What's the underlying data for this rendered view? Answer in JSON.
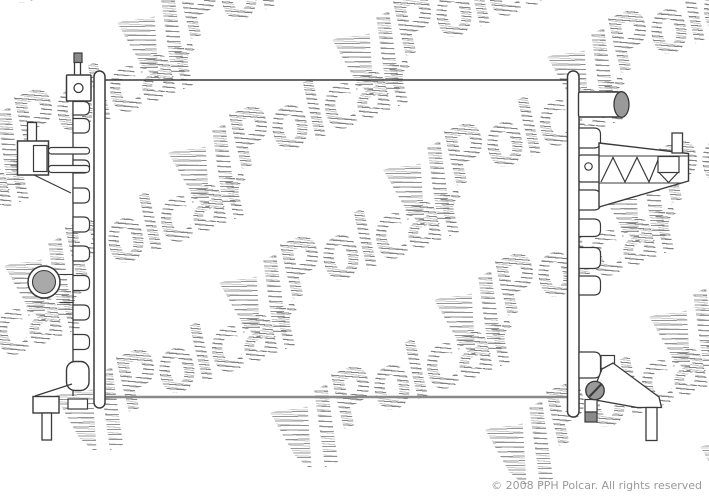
{
  "image": {
    "width": 709,
    "height": 496,
    "background": "#ffffff",
    "description": "Technical line drawing of an automotive radiator from a Polcar parts catalog"
  },
  "copyright": {
    "text": "© 2008 PPH Polcar. All rights reserved",
    "color": "#9a9a9a"
  },
  "watermark": {
    "text": "Polcar",
    "rotation_deg": -22,
    "stripe_color": "#828282",
    "lattice": {
      "origin": [
        325,
        22
      ],
      "col_step": [
        215,
        17
      ],
      "row_step": [
        51,
        130
      ],
      "cols": [
        -3,
        2
      ],
      "rows": [
        0,
        3
      ]
    }
  },
  "palette": {
    "line": "#3a3a3a",
    "light_line": "#8a8a8a",
    "white": "#ffffff",
    "gray_fill": "#a9a9a9",
    "mid_gray": "#999999",
    "dark_gray": "#8a8a8a",
    "none": "none"
  },
  "drawing": {
    "shapes": [
      {
        "name": "core-top-edge",
        "type": "line",
        "x1": 104,
        "y1": 80,
        "x2": 569,
        "y2": 80,
        "stroke": "line",
        "sw": 1.6
      },
      {
        "name": "core-bottom-edge",
        "type": "line",
        "x1": 104,
        "y1": 397,
        "x2": 569,
        "y2": 397,
        "stroke": "light_line",
        "sw": 2.6
      },
      {
        "name": "left-side-plate",
        "type": "rect",
        "x": 94,
        "y": 71,
        "w": 11,
        "h": 337,
        "rx": 5.5,
        "fill": "white",
        "stroke": "line",
        "sw": 1.5
      },
      {
        "name": "right-side-plate",
        "type": "rect",
        "x": 567.5,
        "y": 71,
        "w": 11.5,
        "h": 346,
        "rx": 5.5,
        "fill": "white",
        "stroke": "line",
        "sw": 1.5
      },
      {
        "name": "left-tank-edge",
        "type": "line",
        "x1": 73,
        "y1": 100.5,
        "x2": 73,
        "y2": 396,
        "stroke": "line",
        "sw": 1.3
      },
      {
        "name": "left-tank-tabs",
        "type": "tabs",
        "x": 73,
        "w": 16.5,
        "r": 6,
        "stroke": "line",
        "sw": 1.2,
        "fill": "white",
        "items": [
          [
            101.5,
            13.5
          ],
          [
            118.5,
            14.5
          ],
          [
            160,
            13
          ],
          [
            188,
            15
          ],
          [
            217,
            15
          ],
          [
            246,
            15
          ],
          [
            275.5,
            15
          ],
          [
            305,
            15
          ],
          [
            334.5,
            15
          ]
        ]
      },
      {
        "name": "bleed-screw-stem",
        "type": "rect",
        "x": 74.5,
        "y": 61.5,
        "w": 6,
        "h": 14,
        "rx": 0,
        "fill": "white",
        "stroke": "line",
        "sw": 1.3
      },
      {
        "name": "bleed-screw-cap",
        "type": "rect",
        "x": 74,
        "y": 53,
        "w": 8,
        "h": 9.5,
        "rx": 0,
        "fill": "dark_gray",
        "stroke": "line",
        "sw": 1.2
      },
      {
        "name": "upper-mount-bracket",
        "type": "rect",
        "x": 66.5,
        "y": 75,
        "w": 24.5,
        "h": 26,
        "rx": 1,
        "fill": "white",
        "stroke": "line",
        "sw": 1.5
      },
      {
        "name": "upper-bracket-hole",
        "type": "circle",
        "cx": 78.5,
        "cy": 88,
        "r": 4.5,
        "fill": "white",
        "stroke": "line",
        "sw": 1.3
      },
      {
        "name": "hose-clamp-stem",
        "type": "rect",
        "x": 27.5,
        "y": 122.5,
        "w": 9,
        "h": 19.5,
        "rx": 0,
        "fill": "white",
        "stroke": "line",
        "sw": 1.3
      },
      {
        "name": "hose-clamp-body",
        "type": "rect",
        "x": 17.5,
        "y": 141,
        "w": 31,
        "h": 34,
        "rx": 0,
        "fill": "white",
        "stroke": "line",
        "sw": 1.5
      },
      {
        "name": "hose-clamp-inner",
        "type": "rect",
        "x": 33.5,
        "y": 145.5,
        "w": 13.5,
        "h": 26,
        "rx": 0,
        "fill": "white",
        "stroke": "line",
        "sw": 1.2
      },
      {
        "name": "clamp-bar-upper",
        "type": "rect",
        "x": 48.5,
        "y": 147.5,
        "w": 41,
        "h": 6.5,
        "rx": 3,
        "fill": "white",
        "stroke": "line",
        "sw": 1.2
      },
      {
        "name": "clamp-bar-lower",
        "type": "rect",
        "x": 48.5,
        "y": 165.5,
        "w": 41,
        "h": 7,
        "rx": 3,
        "fill": "white",
        "stroke": "line",
        "sw": 1.2
      },
      {
        "name": "clamp-diagonal",
        "type": "line",
        "x1": 34,
        "y1": 175,
        "x2": 71,
        "y2": 193,
        "stroke": "line",
        "sw": 1.2
      },
      {
        "name": "left-port-ring",
        "type": "circle",
        "cx": 44,
        "cy": 282,
        "r": 16,
        "fill": "white",
        "stroke": "line",
        "sw": 1.5
      },
      {
        "name": "left-port-plug",
        "type": "circle",
        "cx": 44,
        "cy": 282,
        "r": 11.5,
        "fill": "gray_fill",
        "stroke": "line",
        "sw": 1.1
      },
      {
        "name": "left-port-line-upper",
        "type": "line",
        "x1": 59.5,
        "y1": 274.5,
        "x2": 73,
        "y2": 274.5,
        "stroke": "line",
        "sw": 1.1
      },
      {
        "name": "left-port-line-lower",
        "type": "line",
        "x1": 59.5,
        "y1": 302.5,
        "x2": 73,
        "y2": 302.5,
        "stroke": "line",
        "sw": 1.1
      },
      {
        "name": "lower-left-tab",
        "type": "rect",
        "x": 66.5,
        "y": 361.5,
        "w": 22.5,
        "h": 29,
        "rx": 8.5,
        "fill": "white",
        "stroke": "line",
        "sw": 1.4
      },
      {
        "name": "left-foot",
        "type": "rect",
        "x": 33,
        "y": 396.5,
        "w": 26,
        "h": 16.5,
        "rx": 0,
        "fill": "white",
        "stroke": "line",
        "sw": 1.4
      },
      {
        "name": "left-foot-diagonal",
        "type": "line",
        "x1": 35,
        "y1": 396,
        "x2": 72,
        "y2": 384,
        "stroke": "line",
        "sw": 1.2
      },
      {
        "name": "left-foot-pin",
        "type": "rect",
        "x": 42,
        "y": 413,
        "w": 9.5,
        "h": 27,
        "rx": 0,
        "fill": "white",
        "stroke": "line",
        "sw": 1.3
      },
      {
        "name": "left-foot-side-block",
        "type": "rect",
        "x": 68,
        "y": 399,
        "w": 19.5,
        "h": 10,
        "rx": 0,
        "fill": "white",
        "stroke": "line",
        "sw": 1.2
      },
      {
        "name": "right-tank-tabs",
        "type": "tabs",
        "x": 579,
        "w": 21.5,
        "r": 6.5,
        "stroke": "line",
        "sw": 1.2,
        "fill": "white",
        "items": [
          [
            128,
            20
          ],
          [
            190,
            20
          ],
          [
            219,
            17.5
          ],
          [
            247.5,
            21
          ],
          [
            276,
            19
          ],
          [
            352,
            26
          ]
        ]
      },
      {
        "name": "inlet-pipe-body",
        "type": "rect",
        "x": 578.5,
        "y": 92,
        "w": 44,
        "h": 25,
        "rx": 2,
        "fill": "white",
        "stroke": "line",
        "sw": 1.4
      },
      {
        "name": "inlet-pipe-opening",
        "type": "ellipse",
        "cx": 621.5,
        "cy": 104.5,
        "rx": 7.5,
        "ry": 12.8,
        "fill": "mid_gray",
        "stroke": "line",
        "sw": 1.3
      },
      {
        "name": "right-hole-tab",
        "type": "rect",
        "x": 579,
        "y": 155,
        "w": 22,
        "h": 27,
        "rx": 2,
        "fill": "white",
        "stroke": "line",
        "sw": 1.3
      },
      {
        "name": "right-tab-hole",
        "type": "circle",
        "cx": 588.5,
        "cy": 166.5,
        "r": 3.7,
        "fill": "white",
        "stroke": "line",
        "sw": 1.2
      },
      {
        "name": "truss-bracket-body",
        "type": "polygon",
        "pts": [
          [
            599,
            143
          ],
          [
            688.5,
            153.5
          ],
          [
            688.5,
            181
          ],
          [
            599,
            207
          ]
        ],
        "fill": "white",
        "stroke": "line",
        "sw": 1.4
      },
      {
        "name": "truss-top-chord",
        "type": "line",
        "x1": 599,
        "y1": 156,
        "x2": 688,
        "y2": 156,
        "stroke": "line",
        "sw": 1.1
      },
      {
        "name": "truss-zigzag",
        "type": "polyline",
        "pts": [
          [
            601,
            182
          ],
          [
            613,
            157.5
          ],
          [
            625,
            182
          ],
          [
            637,
            157.5
          ],
          [
            649,
            182
          ],
          [
            659,
            157.5
          ]
        ],
        "fill": "none",
        "stroke": "line",
        "sw": 1.2
      },
      {
        "name": "truss-inner-block",
        "type": "rect",
        "x": 658,
        "y": 156.5,
        "w": 21,
        "h": 16,
        "rx": 0,
        "fill": "white",
        "stroke": "line",
        "sw": 1.2
      },
      {
        "name": "truss-inner-vee",
        "type": "polyline",
        "pts": [
          [
            659,
            172.5
          ],
          [
            668.5,
            182.5
          ],
          [
            678,
            172.5
          ]
        ],
        "fill": "none",
        "stroke": "line",
        "sw": 1.2
      },
      {
        "name": "truss-bottom-chord",
        "type": "line",
        "x1": 599,
        "y1": 183,
        "x2": 681,
        "y2": 183,
        "stroke": "line",
        "sw": 1.1
      },
      {
        "name": "truss-stub",
        "type": "rect",
        "x": 672,
        "y": 133,
        "w": 10.5,
        "h": 20,
        "rx": 0,
        "fill": "white",
        "stroke": "line",
        "sw": 1.3
      },
      {
        "name": "lower-arm-mount",
        "type": "rect",
        "x": 601,
        "y": 355.5,
        "w": 13.5,
        "h": 13,
        "rx": 0,
        "fill": "white",
        "stroke": "line",
        "sw": 1.2
      },
      {
        "name": "lower-arm",
        "type": "polygon",
        "pts": [
          [
            613,
            363
          ],
          [
            659,
            397
          ],
          [
            661.5,
            407.5
          ],
          [
            637,
            407.5
          ],
          [
            590,
            399
          ],
          [
            602,
            369
          ]
        ],
        "fill": "white",
        "stroke": "line",
        "sw": 1.3
      },
      {
        "name": "lower-arm-pin",
        "type": "rect",
        "x": 646,
        "y": 407.5,
        "w": 11,
        "h": 33,
        "rx": 0,
        "fill": "white",
        "stroke": "line",
        "sw": 1.3
      },
      {
        "name": "drain-tube",
        "type": "rect",
        "x": 585,
        "y": 399.5,
        "w": 12,
        "h": 12.5,
        "rx": 0,
        "fill": "white",
        "stroke": "line",
        "sw": 1.2
      },
      {
        "name": "drain-tube-tip",
        "type": "rect",
        "x": 585,
        "y": 412,
        "w": 12,
        "h": 10,
        "rx": 0,
        "fill": "dark_gray",
        "stroke": "line",
        "sw": 1.2
      },
      {
        "name": "drain-plug",
        "type": "circle",
        "cx": 595,
        "cy": 390.5,
        "r": 9.2,
        "fill": "mid_gray",
        "stroke": "line",
        "sw": 1.4
      },
      {
        "name": "drain-plug-slot",
        "type": "line",
        "x1": 589.5,
        "y1": 396.5,
        "x2": 601,
        "y2": 384.5,
        "stroke": "line",
        "sw": 2
      }
    ]
  }
}
